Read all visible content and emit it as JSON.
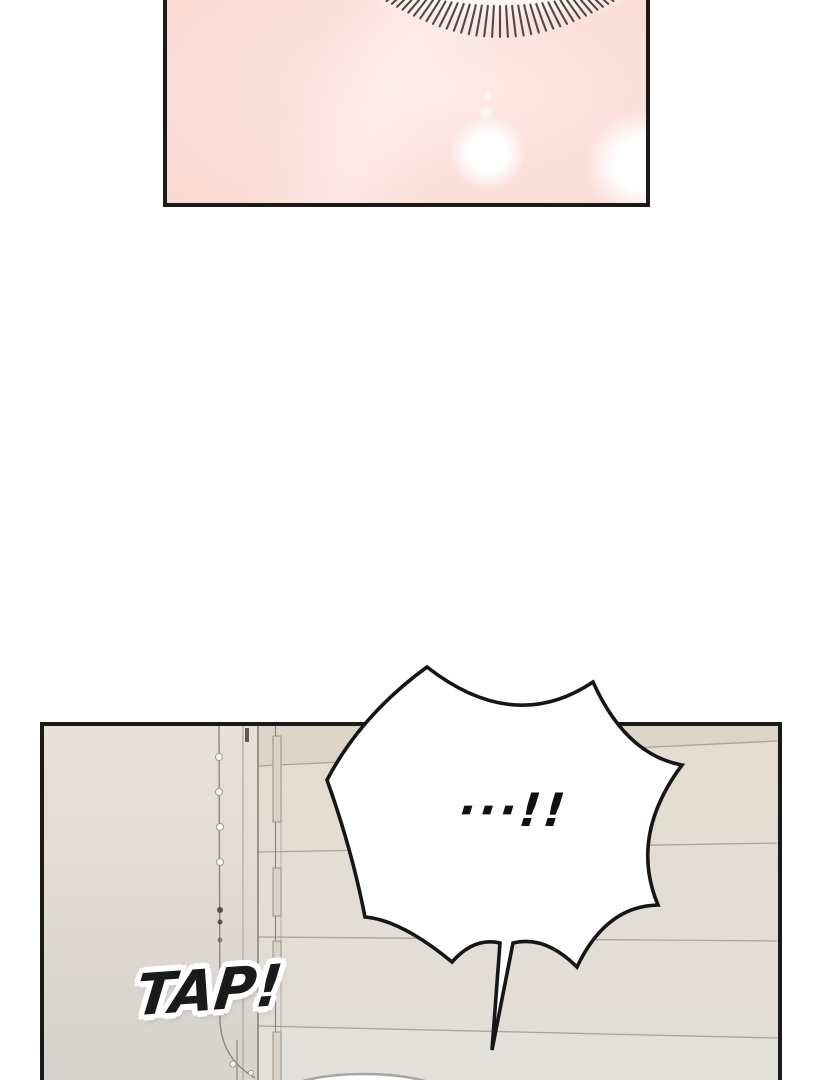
{
  "page": {
    "kind": "webtoon comic page",
    "background": "#ffffff"
  },
  "panels": {
    "eye_closeup": {
      "label": "closed eye close-up on pink skin"
    },
    "room": {
      "label": "room wall with folding door and beaded blind cord"
    }
  },
  "speech_bubble": {
    "text": "···!!"
  },
  "sfx": {
    "text": "TAP!"
  },
  "css_vars": {
    "ink": "#1a1a1a",
    "skin": "#fbdad4",
    "skin-light": "#fdeae4",
    "skin-deep": "#f9d5cf",
    "lash": "#403d3d",
    "wall-top": "#e9e1d6",
    "wall-bottom": "#d3d2ce",
    "door-top": "#e4dccd",
    "door-bottom": "#e1ded7",
    "door-line": "#a8a29a",
    "bubble-fill": "#ffffff",
    "bubble-stroke": "#161616"
  }
}
